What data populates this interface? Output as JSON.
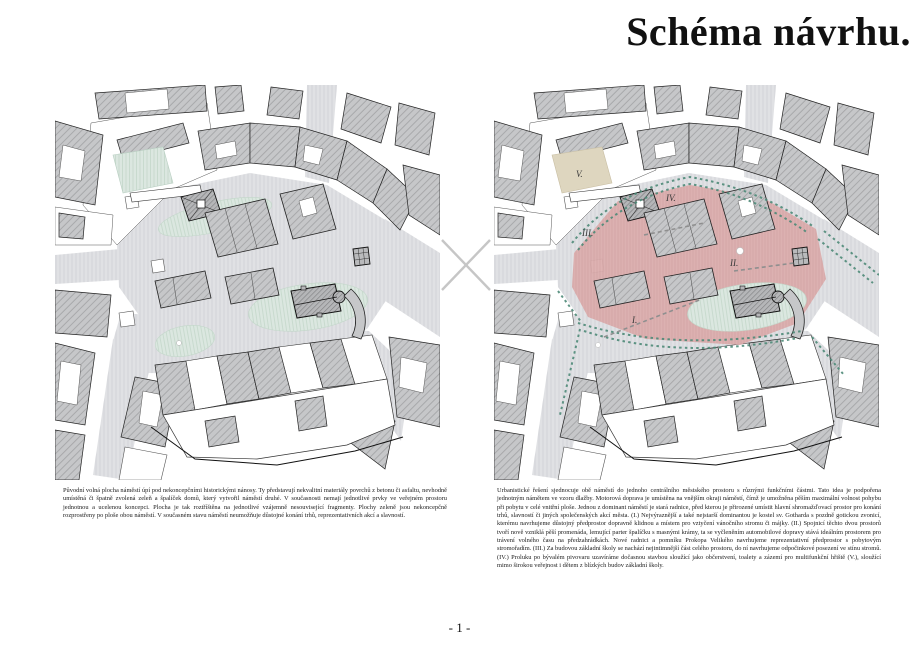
{
  "page": {
    "title": "Schéma návrhu.",
    "page_number": "- 1 -"
  },
  "left_figure": {
    "caption": "Původní volná plocha náměstí úpí pod nekoncepčními historickými nánosy. Ty představují nekvalitní materiály povrchů z betonu či asfaltu, nevhodně umístěná či špatně zvolená zeleň a špalíček domů, který vytvořil náměstí druhé. V současnosti nemají jednotlivé prvky ve veřejném prostoru jednotnou a ucelenou koncepci. Plocha je tak roztříštěna na jednotlivé vzájemně nesouvisející fragmenty. Plochy zeleně jsou nekoncepčně rozprostřeny po ploše obou náměstí. V současném stavu náměstí neumožňuje důstojné konání trhů, reprezentativních akcí a slavností."
  },
  "right_figure": {
    "caption": "Urbanistické řešení sjednocuje obě náměstí do jednoho centrálního městského prostoru s různými funkčními částmi. Tato idea je podpořena jednotným námětem ve vzoru dlažby. Motorová doprava je umístěna na vnějším okraji náměstí, čímž je umožněna pěším maximální volnost pohybu při pobytu v celé vnitřní ploše. Jednou z dominant náměstí je stará radnice, před kterou je přirozené umístit hlavní shromažďovací prostor pro konání trhů, slavností či jiných společenských akcí města. (I.) Nejvýraznější a také nejstarší dominantou je kostel sv. Gotharda s pozdně gotickou zvonicí, kterému navrhujeme důstojný předprostor dopravně klidnou a místem pro vztyčení vánočního stromu či májky. (II.) Spojnicí těchto dvou prostorů tvoří nově vzniklá pěší promenáda, lemující parter špalíčku s masnými krámy, ta se vyčleněním automobilové dopravy stává ideálním prostorem pro trávení volného času na předzahrádkách. Nové radnici a pomníku Prokopa Velikého navrhujeme reprezentativní předprostor s pobytovým stromořadím. (III.) Za budovou základní školy se nachází nejintimnější část celého prostoru, do ní navrhujeme odpočinkové posezení ve stínu stromů. (IV.) Proluku po bývalém pivovaru uzavíráme dočasnou stavbou sloužící jako občerstvení, toalety a zázemí pro multifunkční hřiště (V.), sloužící mimo širokou veřejnost i dětem z blízkých budov základní školy.",
    "labels": [
      "I.",
      "II.",
      "III.",
      "IV.",
      "V."
    ]
  },
  "colors": {
    "square_highlight": "#dcaeae",
    "greenery": "#dbe7e0",
    "sand_area": "#ded6bf",
    "tree_line": "#4e8a78",
    "street": "#e0e1e4",
    "building": "#c6c7c9"
  }
}
